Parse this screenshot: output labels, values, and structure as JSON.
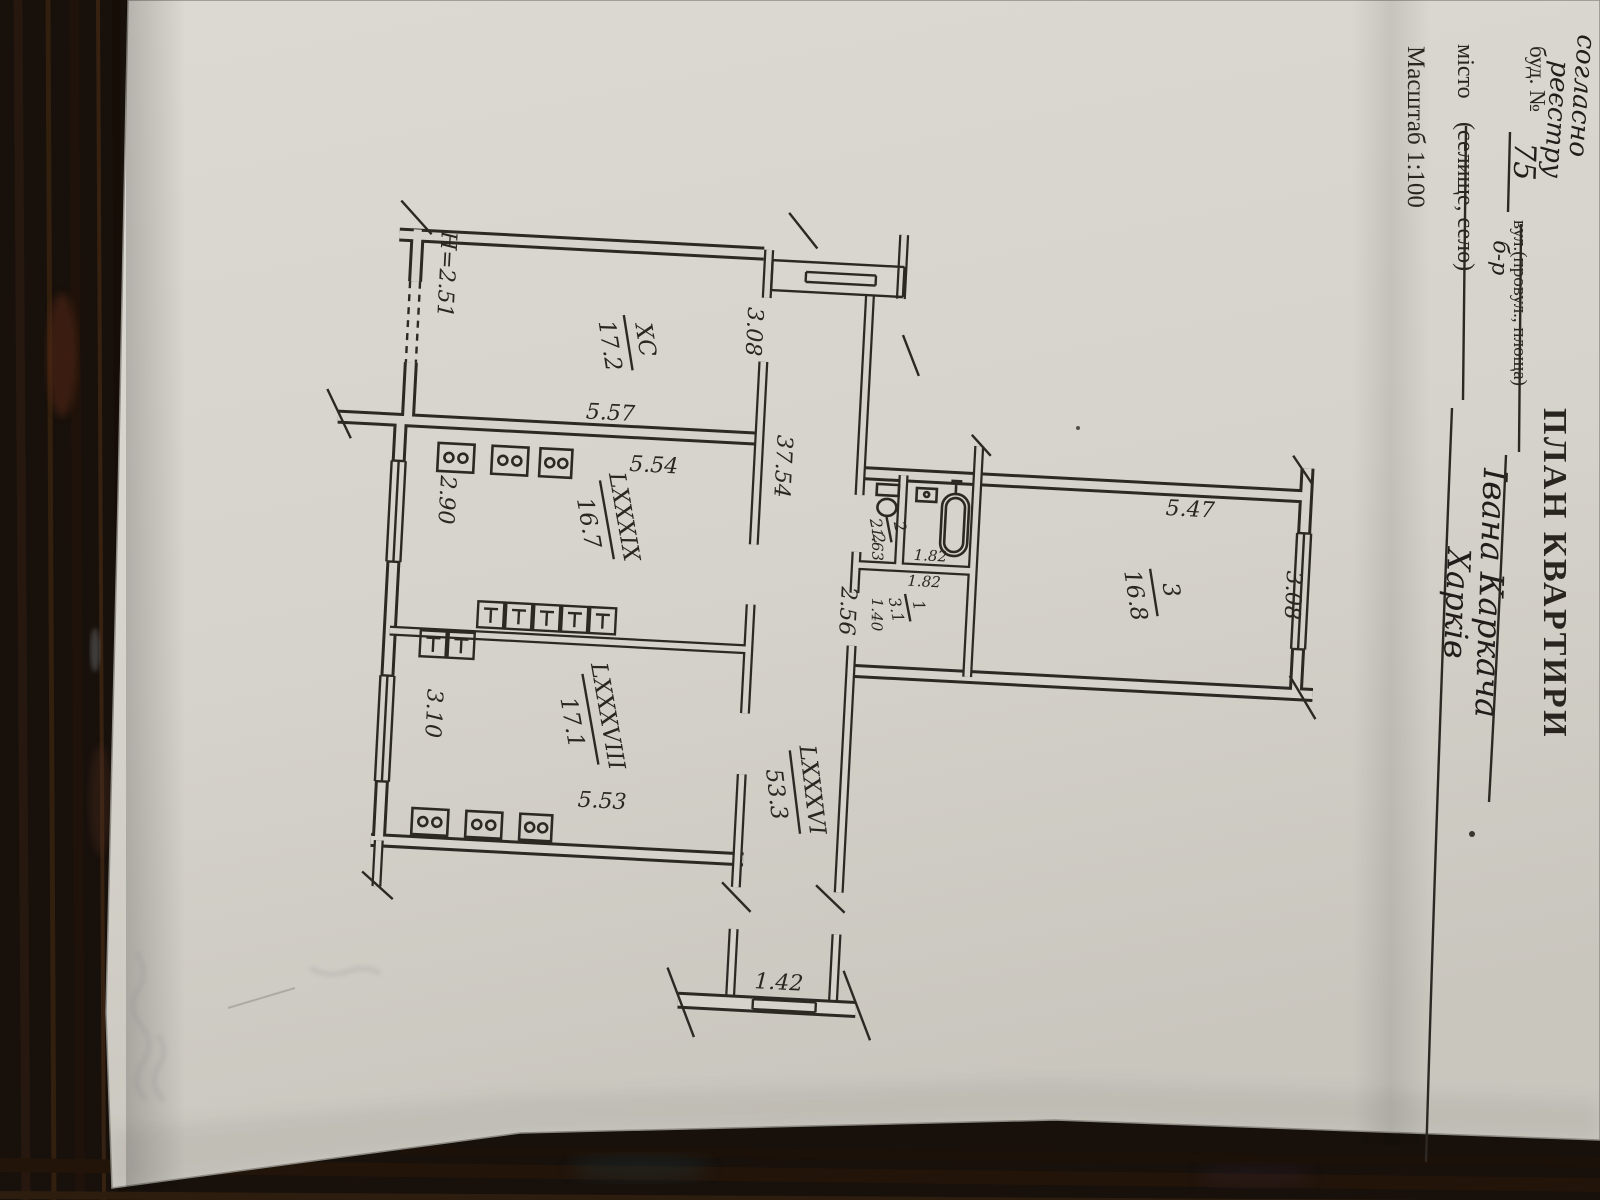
{
  "form": {
    "title": "ПЛАН КВАРТИРИ",
    "note_line1": "согласно",
    "note_line2": "реєстру",
    "building_label": "буд. №",
    "building_number": "75",
    "street_label": "вул.(провул., площа)",
    "street_type": "б-р",
    "street_name": "Івана Каркача",
    "city_label": "місто",
    "city_sublabel": "(селище, село)",
    "city_name": "Харків",
    "scale_label": "Масштаб 1:100"
  },
  "plan": {
    "ceiling_height": "H=2.51",
    "rooms": [
      {
        "id": "kitchen",
        "number": "XC",
        "area": "17.2"
      },
      {
        "id": "room-middle",
        "number": "LXXXIX",
        "area": "16.7"
      },
      {
        "id": "room-bottom",
        "number": "LXXXVIII",
        "area": "17.1"
      },
      {
        "id": "corridor",
        "number": "LXXXVI",
        "area": "53.3"
      },
      {
        "id": "room-right",
        "number": "3",
        "area": "16.8"
      },
      {
        "id": "wc",
        "number": "2",
        "area": "2.2"
      },
      {
        "id": "bath",
        "number": "1",
        "area": "3.1"
      }
    ],
    "dimensions": {
      "kitchen_width": "5.57",
      "kitchen_depth": "3.08",
      "mid_room_width": "5.54",
      "mid_window": "2.90",
      "corridor_length": "37.54",
      "corridor_width": "2.56",
      "bottom_window": "3.10",
      "bottom_room_width": "5.53",
      "corridor_end_window": "1.42",
      "right_room_width": "5.47",
      "right_room_depth": "3.08",
      "wc_width": "1.63",
      "wc_depth": "1.82",
      "bath_depth": "1.82",
      "bath_width": "1.40"
    }
  }
}
